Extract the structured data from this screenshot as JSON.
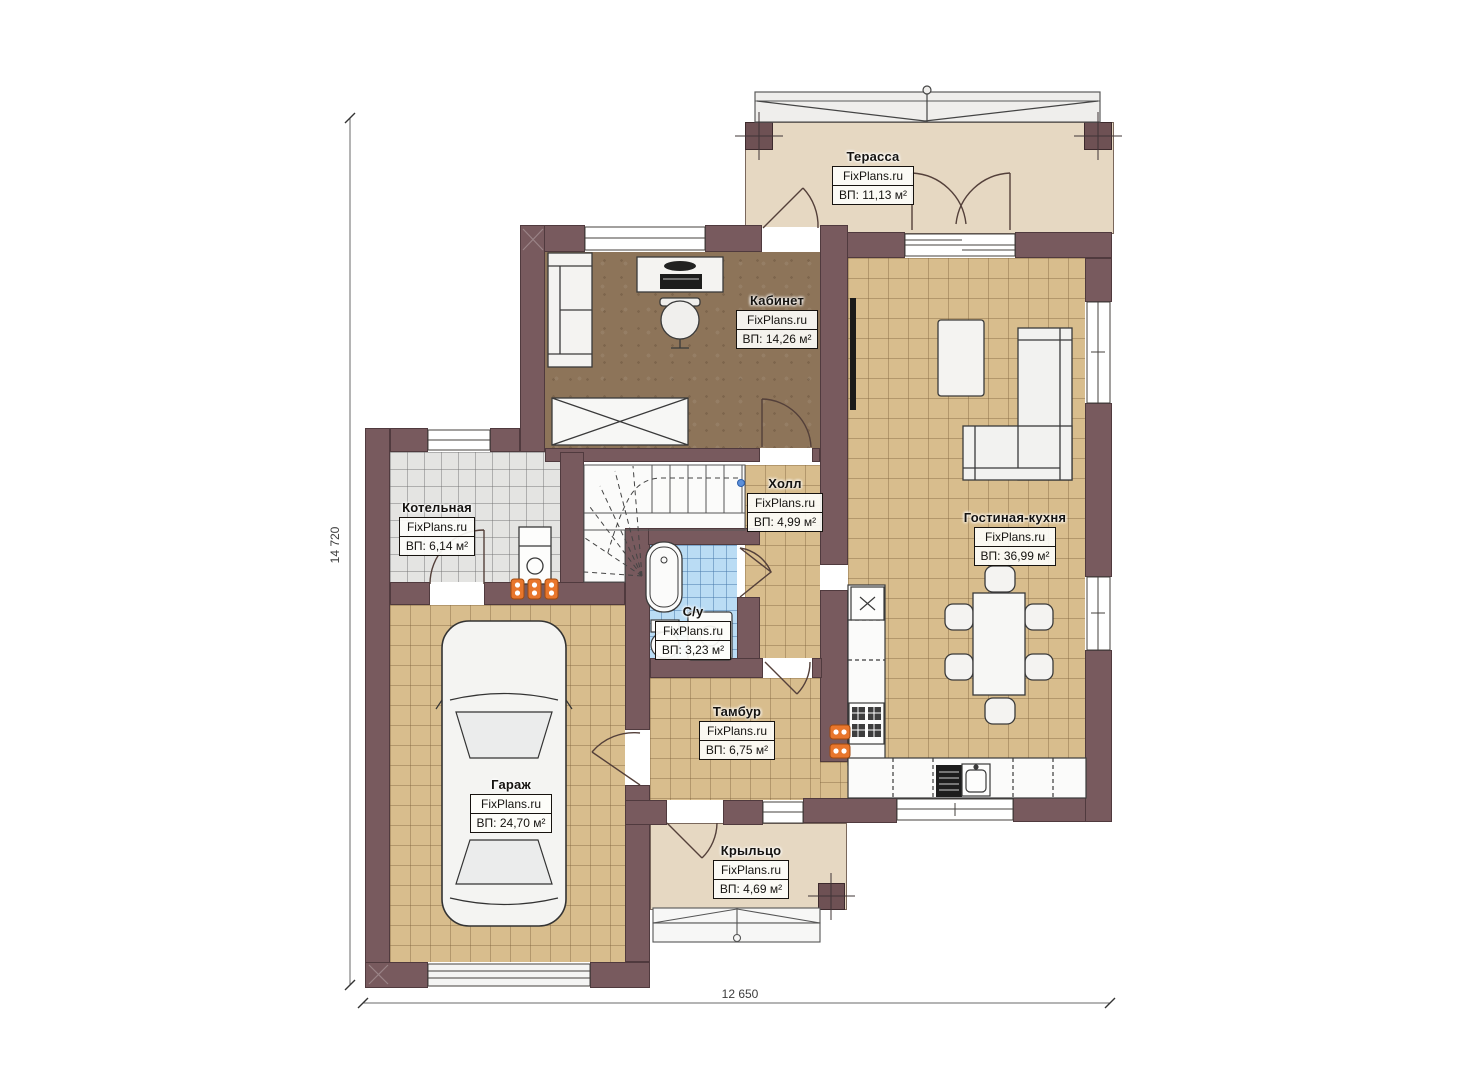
{
  "watermark": "FixPlans.ru",
  "rooms": [
    {
      "name": "Терасса",
      "area": "ВП: 11,13 м²"
    },
    {
      "name": "Кабинет",
      "area": "ВП: 14,26 м²"
    },
    {
      "name": "Котельная",
      "area": "ВП: 6,14 м²"
    },
    {
      "name": "Холл",
      "area": "ВП: 4,99 м²"
    },
    {
      "name": "Гостиная-кухня",
      "area": "ВП: 36,99 м²"
    },
    {
      "name": "С/у",
      "area": "ВП: 3,23 м²"
    },
    {
      "name": "Тамбур",
      "area": "ВП: 6,75 м²"
    },
    {
      "name": "Гараж",
      "area": "ВП: 24,70 м²"
    },
    {
      "name": "Крыльцо",
      "area": "ВП: 4,69 м²"
    }
  ],
  "dimensions": {
    "height": "14 720",
    "width": "12 650"
  },
  "colors": {
    "wall": "#785a5e",
    "floor_tile": "#d8bd8d",
    "office_floor": "#8d7459",
    "boiler_floor": "#e4e4e2",
    "bath_tile": "#badcf4",
    "terrace_floor": "#e6d8c2",
    "radiator": "#e8762c"
  }
}
